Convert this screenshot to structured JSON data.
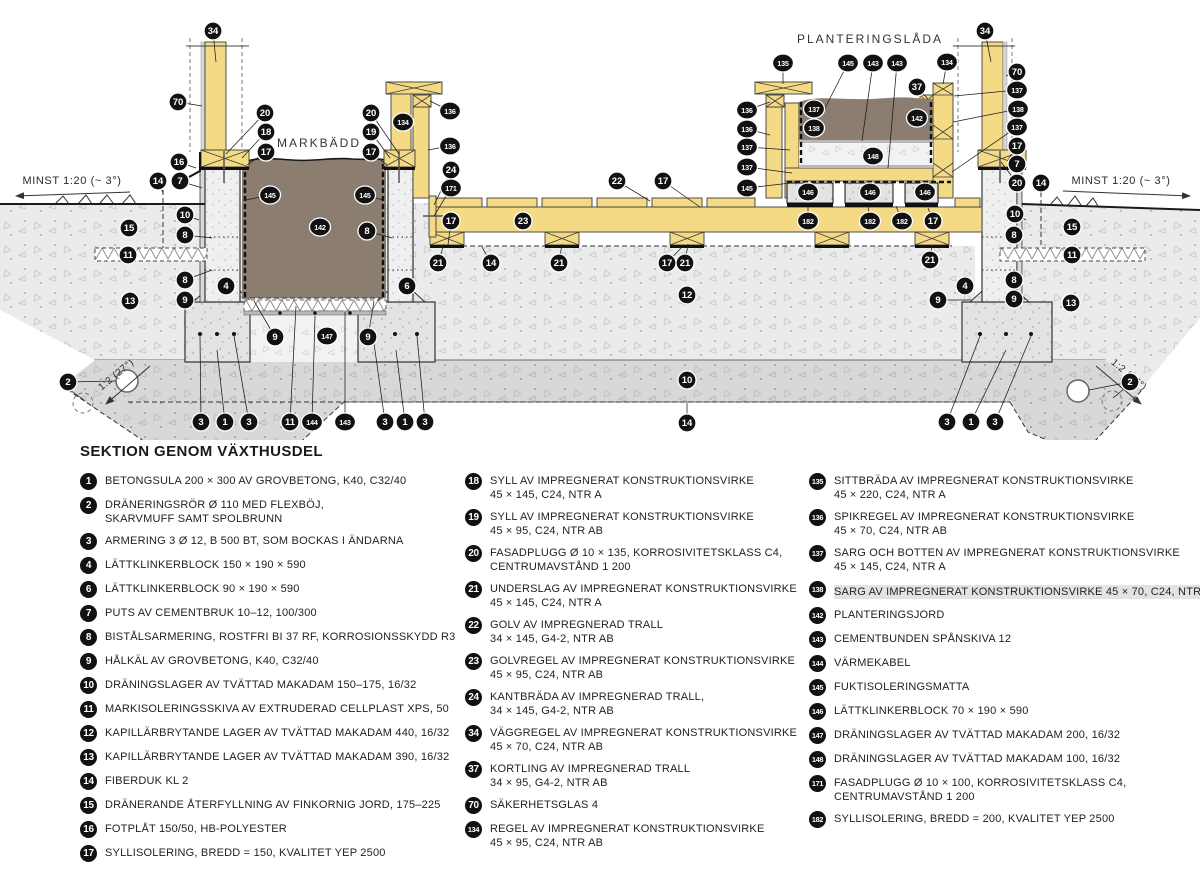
{
  "legend": {
    "title": "SEKTION GENOM VÄXTHUSDEL",
    "columns": [
      [
        {
          "num": "1",
          "lines": [
            "BETONGSULA 200 × 300 AV GROVBETONG, K40, C32/40"
          ]
        },
        {
          "num": "2",
          "lines": [
            "DRÄNERINGSRÖR Ø 110 MED FLEXBÖJ,",
            "SKARVMUFF SAMT SPOLBRUNN"
          ]
        },
        {
          "num": "3",
          "lines": [
            "ARMERING 3 Ø 12, B 500 BT, SOM BOCKAS I ÄNDARNA"
          ]
        },
        {
          "num": "4",
          "lines": [
            "LÄTTKLINKERBLOCK 150 × 190 × 590"
          ]
        },
        {
          "num": "6",
          "lines": [
            "LÄTTKLINKERBLOCK 90 × 190 × 590"
          ]
        },
        {
          "num": "7",
          "lines": [
            "PUTS AV CEMENTBRUK 10–12, 100/300"
          ]
        },
        {
          "num": "8",
          "lines": [
            "BISTÅLSARMERING, ROSTFRI BI 37 RF, KORROSIONSSKYDD R3"
          ]
        },
        {
          "num": "9",
          "lines": [
            "HÅLKÄL AV GROVBETONG, K40, C32/40"
          ]
        },
        {
          "num": "10",
          "lines": [
            "DRÄNINGSLAGER AV TVÄTTAD MAKADAM 150–175, 16/32"
          ]
        },
        {
          "num": "11",
          "lines": [
            "MARKISOLERINGSSKIVA AV EXTRUDERAD CELLPLAST XPS, 50"
          ]
        },
        {
          "num": "12",
          "lines": [
            "KAPILLÄRBRYTANDE LAGER AV TVÄTTAD MAKADAM 440, 16/32"
          ]
        },
        {
          "num": "13",
          "lines": [
            "KAPILLÄRBRYTANDE LAGER AV TVÄTTAD MAKADAM 390, 16/32"
          ]
        },
        {
          "num": "14",
          "lines": [
            "FIBERDUK KL 2"
          ]
        },
        {
          "num": "15",
          "lines": [
            "DRÄNERANDE ÅTERFYLLNING AV FINKORNIG JORD, 175–225"
          ]
        },
        {
          "num": "16",
          "lines": [
            "FOTPLÅT 150/50, HB-POLYESTER"
          ]
        },
        {
          "num": "17",
          "lines": [
            "SYLLISOLERING, BREDD = 150, KVALITET YEP 2500"
          ]
        }
      ],
      [
        {
          "num": "18",
          "lines": [
            "SYLL AV IMPREGNERAT KONSTRUKTIONSVIRKE",
            "45 × 145, C24, NTR A"
          ]
        },
        {
          "num": "19",
          "lines": [
            "SYLL AV IMPREGNERAT KONSTRUKTIONSVIRKE",
            "45 × 95, C24, NTR AB"
          ]
        },
        {
          "num": "20",
          "lines": [
            "FASADPLUGG Ø 10 × 135, KORROSIVITETSKLASS C4,",
            "CENTRUMAVSTÅND 1 200"
          ]
        },
        {
          "num": "21",
          "lines": [
            "UNDERSLAG AV IMPREGNERAT KONSTRUKTIONSVIRKE",
            "45 × 145, C24, NTR A"
          ]
        },
        {
          "num": "22",
          "lines": [
            "GOLV AV IMPREGNERAD TRALL",
            "34 × 145, G4-2, NTR AB"
          ]
        },
        {
          "num": "23",
          "lines": [
            "GOLVREGEL AV IMPREGNERAT KONSTRUKTIONSVIRKE",
            "45 × 95, C24, NTR AB"
          ]
        },
        {
          "num": "24",
          "lines": [
            "KANTBRÄDA AV IMPREGNERAD TRALL,",
            "34 × 145, G4-2, NTR AB"
          ]
        },
        {
          "num": "34",
          "lines": [
            "VÄGGREGEL AV IMPREGNERAT KONSTRUKTIONSVIRKE",
            "45 × 70, C24, NTR AB"
          ]
        },
        {
          "num": "37",
          "lines": [
            "KORTLING AV IMPREGNERAD TRALL",
            "34 × 95, G4-2, NTR AB"
          ]
        },
        {
          "num": "70",
          "lines": [
            "SÄKERHETSGLAS 4"
          ]
        },
        {
          "num": "134",
          "lines": [
            "REGEL AV IMPREGNERAT KONSTRUKTIONSVIRKE",
            "45 × 95, C24, NTR AB"
          ]
        }
      ],
      [
        {
          "num": "135",
          "lines": [
            "SITTBRÄDA AV IMPREGNERAT KONSTRUKTIONSVIRKE",
            "45 × 220, C24, NTR A"
          ]
        },
        {
          "num": "136",
          "lines": [
            "SPIKREGEL AV IMPREGNERAT KONSTRUKTIONSVIRKE",
            "45 × 70, C24, NTR AB"
          ]
        },
        {
          "num": "137",
          "lines": [
            "SARG OCH BOTTEN AV IMPREGNERAT KONSTRUKTIONSVIRKE",
            "45 × 145, C24, NTR A"
          ]
        },
        {
          "num": "138",
          "hl": true,
          "lines": [
            "SARG AV IMPREGNERAT KONSTRUKTIONSVIRKE 45 × 70, C24, NTR AB"
          ]
        },
        {
          "num": "142",
          "lines": [
            "PLANTERINGSJORD"
          ]
        },
        {
          "num": "143",
          "lines": [
            "CEMENTBUNDEN SPÅNSKIVA 12"
          ]
        },
        {
          "num": "144",
          "lines": [
            "VÄRMEKABEL"
          ]
        },
        {
          "num": "145",
          "lines": [
            "FUKTISOLERINGSMATTA"
          ]
        },
        {
          "num": "146",
          "lines": [
            "LÄTTKLINKERBLOCK 70 × 190 × 590"
          ]
        },
        {
          "num": "147",
          "lines": [
            "DRÄNINGSLAGER AV TVÄTTAD MAKADAM 200, 16/32"
          ]
        },
        {
          "num": "148",
          "lines": [
            "DRÄNINGSLAGER AV TVÄTTAD MAKADAM 100, 16/32"
          ]
        },
        {
          "num": "171",
          "lines": [
            "FASADPLUGG Ø 10 × 100, KORROSIVITETSKLASS C4,",
            "CENTRUMAVSTÅND 1 200"
          ]
        },
        {
          "num": "182",
          "lines": [
            "SYLLISOLERING, BREDD = 200, KVALITET YEP 2500"
          ]
        }
      ]
    ]
  },
  "drawing": {
    "labels": [
      {
        "text": "MARKBÄDD",
        "x": 319,
        "y": 147,
        "cls": "big"
      },
      {
        "text": "PLANTERINGSLÅDA",
        "x": 870,
        "y": 43,
        "cls": "big"
      },
      {
        "text": "MINST 1:20 (~ 3°)",
        "x": 72,
        "y": 184
      },
      {
        "text": "MINST 1:20 (~ 3°)",
        "x": 1121,
        "y": 184
      },
      {
        "text": "1:2 (27°)",
        "x": 118,
        "y": 377,
        "rotate": -40,
        "cls": "slope"
      },
      {
        "text": "1:2 (27°)",
        "x": 1127,
        "y": 377,
        "rotate": 40,
        "cls": "slope"
      }
    ],
    "callouts": [
      {
        "n": "34",
        "x": 213,
        "y": 31,
        "tx": 216,
        "ty": 62
      },
      {
        "n": "70",
        "x": 178,
        "y": 102,
        "tx": 202,
        "ty": 106
      },
      {
        "n": "20",
        "x": 265,
        "y": 113,
        "tx": 226,
        "ty": 154
      },
      {
        "n": "18",
        "x": 266,
        "y": 132,
        "tx": 242,
        "ty": 158
      },
      {
        "n": "17",
        "x": 266,
        "y": 152,
        "tx": 247,
        "ty": 165
      },
      {
        "n": "16",
        "x": 179,
        "y": 162,
        "tx": 196,
        "ty": 168
      },
      {
        "n": "14",
        "x": 158,
        "y": 181,
        "tx": 163,
        "ty": 193
      },
      {
        "n": "7",
        "x": 180,
        "y": 181,
        "tx": 202,
        "ty": 188
      },
      {
        "n": "10",
        "x": 185,
        "y": 215,
        "tx": 199,
        "ty": 220
      },
      {
        "n": "15",
        "x": 129,
        "y": 228
      },
      {
        "n": "8",
        "x": 185,
        "y": 235,
        "tx": 212,
        "ty": 238
      },
      {
        "n": "11",
        "x": 128,
        "y": 255
      },
      {
        "n": "8",
        "x": 185,
        "y": 280,
        "tx": 212,
        "ty": 270
      },
      {
        "n": "4",
        "x": 226,
        "y": 286
      },
      {
        "n": "9",
        "x": 185,
        "y": 300,
        "tx": 197,
        "ty": 299
      },
      {
        "n": "13",
        "x": 130,
        "y": 301
      },
      {
        "n": "2",
        "x": 68,
        "y": 382,
        "tx": 116,
        "ty": 381
      },
      {
        "n": "3",
        "x": 201,
        "y": 422,
        "tx": 200,
        "ty": 336
      },
      {
        "n": "1",
        "x": 225,
        "y": 422,
        "tx": 217,
        "ty": 350
      },
      {
        "n": "3",
        "x": 249,
        "y": 422,
        "tx": 234,
        "ty": 336
      },
      {
        "n": "11",
        "x": 290,
        "y": 422,
        "tx": 296,
        "ty": 306
      },
      {
        "n": "144",
        "x": 312,
        "y": 422,
        "tx": 315,
        "ty": 316
      },
      {
        "n": "143",
        "x": 345,
        "y": 422,
        "tx": 345,
        "ty": 312
      },
      {
        "n": "3",
        "x": 385,
        "y": 422,
        "tx": 373,
        "ty": 336
      },
      {
        "n": "1",
        "x": 405,
        "y": 422,
        "tx": 396,
        "ty": 350
      },
      {
        "n": "3",
        "x": 425,
        "y": 422,
        "tx": 417,
        "ty": 336
      },
      {
        "n": "9",
        "x": 275,
        "y": 337,
        "tx": 254,
        "ty": 301
      },
      {
        "n": "147",
        "x": 327,
        "y": 336
      },
      {
        "n": "9",
        "x": 368,
        "y": 337,
        "tx": 374,
        "ty": 301
      },
      {
        "n": "145",
        "x": 270,
        "y": 195,
        "tx": 246,
        "ty": 200
      },
      {
        "n": "145",
        "x": 365,
        "y": 195,
        "tx": 383,
        "ty": 200
      },
      {
        "n": "142",
        "x": 320,
        "y": 227
      },
      {
        "n": "20",
        "x": 371,
        "y": 113,
        "tx": 399,
        "ty": 154
      },
      {
        "n": "19",
        "x": 371,
        "y": 132,
        "tx": 390,
        "ty": 158
      },
      {
        "n": "17",
        "x": 371,
        "y": 152,
        "tx": 387,
        "ty": 165
      },
      {
        "n": "134",
        "x": 403,
        "y": 122
      },
      {
        "n": "136",
        "x": 450,
        "y": 111,
        "tx": 430,
        "ty": 101
      },
      {
        "n": "136",
        "x": 450,
        "y": 146,
        "tx": 428,
        "ty": 150
      },
      {
        "n": "24",
        "x": 451,
        "y": 170,
        "tx": 434,
        "ty": 205
      },
      {
        "n": "171",
        "x": 451,
        "y": 188,
        "tx": 434,
        "ty": 216
      },
      {
        "n": "17",
        "x": 451,
        "y": 221,
        "tx": 448,
        "ty": 245
      },
      {
        "n": "8",
        "x": 367,
        "y": 231,
        "tx": 392,
        "ty": 238
      },
      {
        "n": "6",
        "x": 407,
        "y": 286
      },
      {
        "n": "21",
        "x": 438,
        "y": 263,
        "tx": 444,
        "ty": 244
      },
      {
        "n": "22",
        "x": 617,
        "y": 181,
        "tx": 650,
        "ty": 201
      },
      {
        "n": "17",
        "x": 663,
        "y": 181,
        "tx": 700,
        "ty": 207
      },
      {
        "n": "23",
        "x": 523,
        "y": 221
      },
      {
        "n": "14",
        "x": 491,
        "y": 263,
        "tx": 482,
        "ty": 247
      },
      {
        "n": "21",
        "x": 559,
        "y": 263,
        "tx": 562,
        "ty": 244
      },
      {
        "n": "17",
        "x": 667,
        "y": 263,
        "tx": 682,
        "ty": 247
      },
      {
        "n": "21",
        "x": 685,
        "y": 263,
        "tx": 688,
        "ty": 244
      },
      {
        "n": "12",
        "x": 687,
        "y": 295
      },
      {
        "n": "10",
        "x": 687,
        "y": 380
      },
      {
        "n": "14",
        "x": 687,
        "y": 423,
        "tx": 687,
        "ty": 403
      },
      {
        "n": "135",
        "x": 783,
        "y": 63,
        "tx": 783,
        "ty": 84
      },
      {
        "n": "145",
        "x": 848,
        "y": 63,
        "tx": 824,
        "ty": 110
      },
      {
        "n": "143",
        "x": 873,
        "y": 63,
        "tx": 862,
        "ty": 141
      },
      {
        "n": "143",
        "x": 897,
        "y": 63,
        "tx": 888,
        "ty": 168
      },
      {
        "n": "134",
        "x": 947,
        "y": 62,
        "tx": 943,
        "ty": 84
      },
      {
        "n": "37",
        "x": 917,
        "y": 87,
        "tx": 928,
        "ty": 99
      },
      {
        "n": "136",
        "x": 747,
        "y": 110,
        "tx": 770,
        "ty": 102
      },
      {
        "n": "136",
        "x": 747,
        "y": 129,
        "tx": 770,
        "ty": 135
      },
      {
        "n": "137",
        "x": 747,
        "y": 147,
        "tx": 790,
        "ty": 150
      },
      {
        "n": "137",
        "x": 747,
        "y": 167,
        "tx": 792,
        "ty": 173
      },
      {
        "n": "145",
        "x": 747,
        "y": 188,
        "tx": 800,
        "ty": 182
      },
      {
        "n": "137",
        "x": 814,
        "y": 109
      },
      {
        "n": "138",
        "x": 814,
        "y": 128
      },
      {
        "n": "142",
        "x": 917,
        "y": 118
      },
      {
        "n": "148",
        "x": 873,
        "y": 156
      },
      {
        "n": "146",
        "x": 808,
        "y": 192
      },
      {
        "n": "146",
        "x": 870,
        "y": 192
      },
      {
        "n": "146",
        "x": 925,
        "y": 192
      },
      {
        "n": "182",
        "x": 808,
        "y": 221,
        "tx": 808,
        "ty": 206
      },
      {
        "n": "182",
        "x": 870,
        "y": 221,
        "tx": 868,
        "ty": 206
      },
      {
        "n": "182",
        "x": 902,
        "y": 221,
        "tx": 896,
        "ty": 206
      },
      {
        "n": "17",
        "x": 933,
        "y": 221,
        "tx": 928,
        "ty": 208
      },
      {
        "n": "21",
        "x": 930,
        "y": 260,
        "tx": 932,
        "ty": 245
      },
      {
        "n": "34",
        "x": 985,
        "y": 31,
        "tx": 991,
        "ty": 62
      },
      {
        "n": "70",
        "x": 1017,
        "y": 72,
        "tx": 1006,
        "ty": 76
      },
      {
        "n": "137",
        "x": 1017,
        "y": 90,
        "tx": 954,
        "ty": 96
      },
      {
        "n": "138",
        "x": 1018,
        "y": 109,
        "tx": 953,
        "ty": 122
      },
      {
        "n": "137",
        "x": 1017,
        "y": 127,
        "tx": 952,
        "ty": 172
      },
      {
        "n": "17",
        "x": 1017,
        "y": 146,
        "tx": 1008,
        "ty": 160
      },
      {
        "n": "7",
        "x": 1017,
        "y": 164,
        "tx": 1020,
        "ty": 176
      },
      {
        "n": "20",
        "x": 1017,
        "y": 183,
        "tx": 1001,
        "ty": 162
      },
      {
        "n": "14",
        "x": 1041,
        "y": 183,
        "tx": 1041,
        "ty": 195
      },
      {
        "n": "10",
        "x": 1015,
        "y": 214,
        "tx": 1026,
        "ty": 220
      },
      {
        "n": "8",
        "x": 1014,
        "y": 235,
        "tx": 1013,
        "ty": 239
      },
      {
        "n": "15",
        "x": 1072,
        "y": 227
      },
      {
        "n": "11",
        "x": 1072,
        "y": 255
      },
      {
        "n": "8",
        "x": 1014,
        "y": 280,
        "tx": 1013,
        "ty": 271
      },
      {
        "n": "4",
        "x": 965,
        "y": 286
      },
      {
        "n": "9",
        "x": 938,
        "y": 300,
        "tx": 972,
        "ty": 300
      },
      {
        "n": "9",
        "x": 1014,
        "y": 299,
        "tx": 1026,
        "ty": 299
      },
      {
        "n": "13",
        "x": 1071,
        "y": 303
      },
      {
        "n": "2",
        "x": 1130,
        "y": 382,
        "tx": 1089,
        "ty": 390
      },
      {
        "n": "3",
        "x": 947,
        "y": 422,
        "tx": 980,
        "ty": 336
      },
      {
        "n": "1",
        "x": 971,
        "y": 422,
        "tx": 1006,
        "ty": 350
      },
      {
        "n": "3",
        "x": 995,
        "y": 422,
        "tx": 1031,
        "ty": 336
      }
    ]
  },
  "colors": {
    "badge": "#111111",
    "wood": "#f4da85",
    "soil": "#8b7d6f",
    "ground": "#ebebeb",
    "drain_layer": "#d8d8d8",
    "concrete": "#e3e3e3"
  }
}
